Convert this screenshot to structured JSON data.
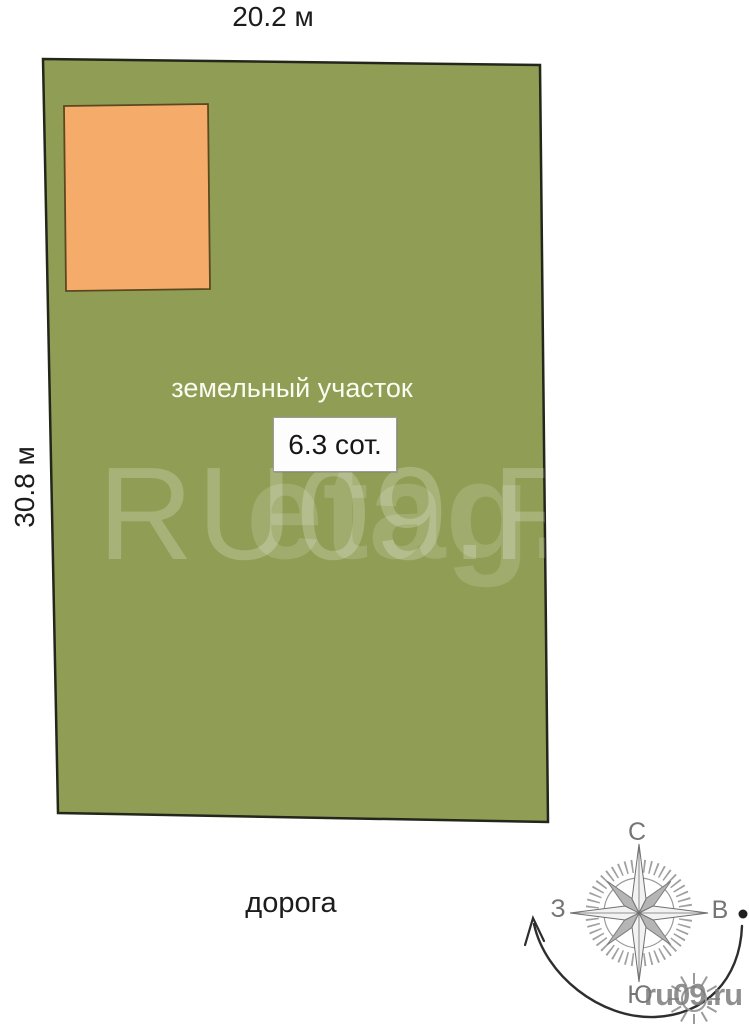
{
  "dimensions": {
    "top": "20.2 м",
    "left": "30.8 м"
  },
  "plot": {
    "label": "земельный участок",
    "area_value": "6.3 сот."
  },
  "road": {
    "label": "дорога"
  },
  "compass": {
    "north_label": "С",
    "west_label": "З",
    "east_label": "В",
    "south_label": "Ю"
  },
  "watermarks": {
    "center_large": "RU09.R",
    "center_small": "etag.i",
    "corner": "ru09.ru"
  },
  "colors": {
    "plot_fill": "#909e55",
    "plot_stroke": "#23261a",
    "building_fill": "#f5ac6b",
    "building_stroke": "#5c481f"
  }
}
